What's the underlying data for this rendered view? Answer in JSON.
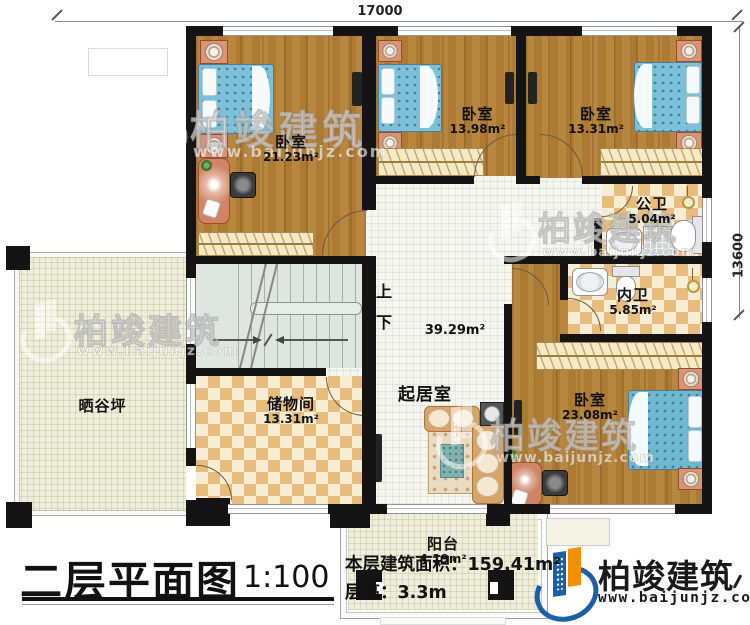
{
  "title_block": {
    "plan_name": "二层平面图",
    "scale": "1:100",
    "floor_area": "本层建筑面积：159.41m²",
    "floor_height": "层高：3.3m"
  },
  "brand": {
    "name": "柏竣建筑",
    "url": "www.baijunjz.com"
  },
  "dimensions": {
    "top": "17000",
    "right": "13600"
  },
  "stairs": {
    "up_label": "上",
    "down_label": "下"
  },
  "rooms": {
    "bedroom_tl": {
      "name": "卧室",
      "area": "21.23m²"
    },
    "bedroom_tm": {
      "name": "卧室",
      "area": "13.98m²"
    },
    "bedroom_tr": {
      "name": "卧室",
      "area": "13.31m²"
    },
    "bath_public": {
      "name": "公卫",
      "area": "5.04m²"
    },
    "bath_private": {
      "name": "内卫",
      "area": "5.85m²"
    },
    "living": {
      "name": "起居室",
      "area": "39.29m²"
    },
    "bedroom_br": {
      "name": "卧室",
      "area": "23.08m²"
    },
    "storage": {
      "name": "储物间",
      "area": "13.31m²"
    },
    "drying_yard": {
      "name": "晒谷坪"
    },
    "balcony": {
      "name": "阳台",
      "area": "4.19m²"
    }
  }
}
